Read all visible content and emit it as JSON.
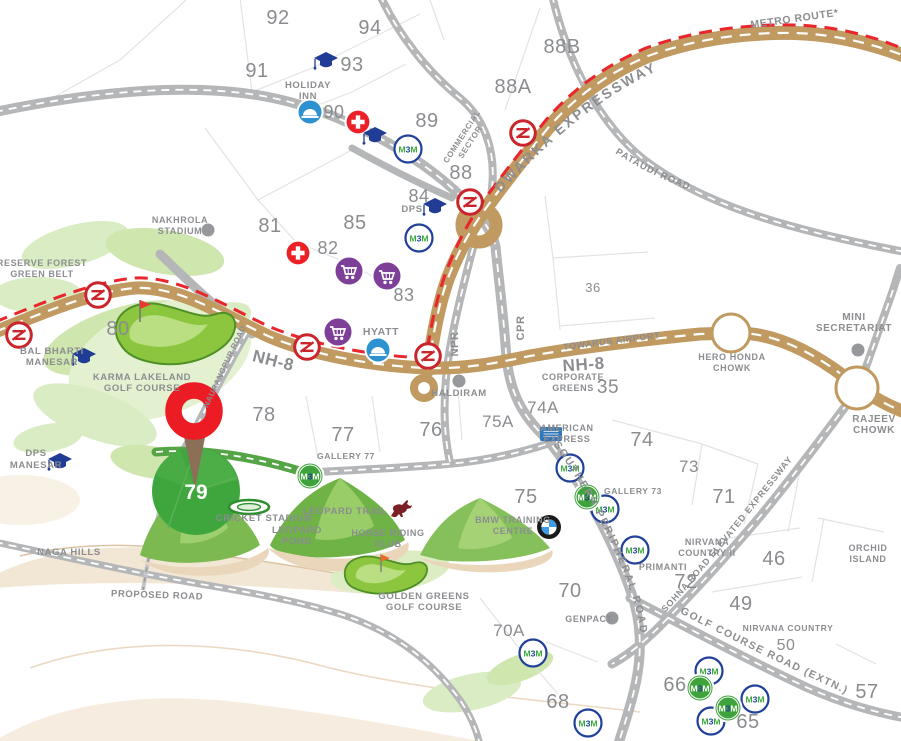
{
  "map": {
    "colors": {
      "highway_tan": "#c09a60",
      "road_gray": "#b5b6b8",
      "metro_red": "#e8262b",
      "label_gray": "#8b8d90",
      "project_green": "#3fa63e",
      "pin_red": "#ec1c24",
      "m3m_green": "#3aa63c",
      "m3m_blue": "#20409a",
      "cart_purple": "#7d3f98",
      "cap_blue": "#203c94",
      "hotel_blue": "#2d92cf",
      "hospital_red": "#ec2127",
      "horse_maroon": "#7b2125"
    },
    "logos": {
      "m3m_m1": "M",
      "m3m_3": "3",
      "m3m_m2": "M"
    },
    "project": {
      "number": "79"
    },
    "road_labels": {
      "dwarka": "DWARKA EXPRESSWAY",
      "pataudi": "PATAUDI ROAD",
      "naurangpur": "NAURANGPUR ROAD",
      "spr": "SOUTHERN PERIPHERAL ROAD",
      "sohna": "SOHNA ROAD ELEVATED EXPRESSWAY",
      "gcr": "GOLF COURSE ROAD (EXTN.)"
    },
    "sectors": [
      {
        "t": "92",
        "x": 278,
        "y": 24
      },
      {
        "t": "94",
        "x": 370,
        "y": 34
      },
      {
        "t": "93",
        "x": 352,
        "y": 71
      },
      {
        "t": "91",
        "x": 257,
        "y": 77
      },
      {
        "t": "90",
        "x": 334,
        "y": 118,
        "s": 18
      },
      {
        "t": "88B",
        "x": 562,
        "y": 53
      },
      {
        "t": "88A",
        "x": 513,
        "y": 93
      },
      {
        "t": "89",
        "x": 427,
        "y": 127
      },
      {
        "t": "88",
        "x": 461,
        "y": 179
      },
      {
        "t": "84",
        "x": 419,
        "y": 202,
        "s": 18
      },
      {
        "t": "85",
        "x": 355,
        "y": 229
      },
      {
        "t": "81",
        "x": 270,
        "y": 232
      },
      {
        "t": "82",
        "x": 328,
        "y": 254,
        "s": 18
      },
      {
        "t": "83",
        "x": 404,
        "y": 301,
        "s": 18
      },
      {
        "t": "80",
        "x": 118,
        "y": 335
      },
      {
        "t": "36",
        "x": 593,
        "y": 292,
        "s": 13
      },
      {
        "t": "35",
        "x": 608,
        "y": 393,
        "s": 19
      },
      {
        "t": "78",
        "x": 264,
        "y": 421
      },
      {
        "t": "77",
        "x": 343,
        "y": 441
      },
      {
        "t": "76",
        "x": 431,
        "y": 436
      },
      {
        "t": "75A",
        "x": 498,
        "y": 427,
        "s": 17
      },
      {
        "t": "74A",
        "x": 543,
        "y": 413,
        "s": 17
      },
      {
        "t": "74",
        "x": 642,
        "y": 446
      },
      {
        "t": "73",
        "x": 689,
        "y": 472,
        "s": 17
      },
      {
        "t": "71",
        "x": 724,
        "y": 503
      },
      {
        "t": "75",
        "x": 526,
        "y": 503
      },
      {
        "t": "70",
        "x": 570,
        "y": 597
      },
      {
        "t": "70A",
        "x": 509,
        "y": 636,
        "s": 17
      },
      {
        "t": "72",
        "x": 686,
        "y": 588
      },
      {
        "t": "46",
        "x": 774,
        "y": 565
      },
      {
        "t": "49",
        "x": 741,
        "y": 610
      },
      {
        "t": "50",
        "x": 786,
        "y": 650,
        "s": 16
      },
      {
        "t": "68",
        "x": 558,
        "y": 708
      },
      {
        "t": "66",
        "x": 675,
        "y": 691
      },
      {
        "t": "65",
        "x": 748,
        "y": 728
      },
      {
        "t": "57",
        "x": 867,
        "y": 698
      }
    ],
    "places": [
      {
        "id": "reserve-forest",
        "lines": [
          "RESERVE FOREST",
          "GREEN BELT"
        ],
        "x": 42,
        "y": 266,
        "s": 9
      },
      {
        "id": "bal-bharti-manesar",
        "lines": [
          "BAL BHARTI",
          "MANESAR"
        ],
        "x": 52,
        "y": 354,
        "s": 9.5
      },
      {
        "id": "karma-lakeland-golf-course",
        "lines": [
          "KARMA LAKELAND",
          "GOLF COURSE"
        ],
        "x": 142,
        "y": 380,
        "s": 9.5
      },
      {
        "id": "nakhrola-stadium",
        "lines": [
          "NAKHROLA",
          "STADIUM"
        ],
        "x": 180,
        "y": 223,
        "s": 9
      },
      {
        "id": "holiday-inn",
        "lines": [
          "HOLIDAY",
          "INN"
        ],
        "x": 308,
        "y": 88,
        "s": 9.5
      },
      {
        "id": "hyatt",
        "lines": [
          "HYATT"
        ],
        "x": 381,
        "y": 335,
        "s": 10.5
      },
      {
        "id": "dps",
        "lines": [
          "DPS"
        ],
        "x": 412,
        "y": 212,
        "s": 9.5
      },
      {
        "id": "dps-manesar",
        "lines": [
          "DPS",
          "MANESAR"
        ],
        "x": 36,
        "y": 456,
        "s": 9.5,
        "lh": 12
      },
      {
        "id": "mini-secretariat",
        "lines": [
          "MINI",
          "SECRETARIAT"
        ],
        "x": 854,
        "y": 320,
        "s": 10
      },
      {
        "id": "hero-honda-chowk",
        "lines": [
          "HERO HONDA",
          "CHOWK"
        ],
        "x": 732,
        "y": 360,
        "s": 9
      },
      {
        "id": "rajeev-chowk",
        "lines": [
          "RAJEEV",
          "CHOWK"
        ],
        "x": 874,
        "y": 422,
        "s": 10
      },
      {
        "id": "corporate-greens",
        "lines": [
          "CORPORATE",
          "GREENS"
        ],
        "x": 573,
        "y": 380,
        "s": 9
      },
      {
        "id": "american-express",
        "lines": [
          "AMERICAN",
          "EXPRESS"
        ],
        "x": 567,
        "y": 431,
        "s": 9,
        "a": "start"
      },
      {
        "id": "haldiram",
        "lines": [
          "HALDIRAM"
        ],
        "x": 459,
        "y": 396,
        "s": 9.5
      },
      {
        "id": "gallery-77",
        "lines": [
          "GALLERY 77"
        ],
        "x": 346,
        "y": 459,
        "s": 8.5
      },
      {
        "id": "gallery-73",
        "lines": [
          "GALLERY 73"
        ],
        "x": 633,
        "y": 494,
        "s": 8.5
      },
      {
        "id": "bmw-training-centre",
        "lines": [
          "BMW TRAINING",
          "CENTRE"
        ],
        "x": 513,
        "y": 523,
        "s": 9
      },
      {
        "id": "nirvana-country-ii",
        "lines": [
          "NIRVANA",
          "COUNTRY II"
        ],
        "x": 707,
        "y": 545,
        "s": 9
      },
      {
        "id": "primanti",
        "lines": [
          "PRIMANTI"
        ],
        "x": 663,
        "y": 570,
        "s": 9
      },
      {
        "id": "nirvana-country",
        "lines": [
          "NIRVANA COUNTRY"
        ],
        "x": 788,
        "y": 631,
        "s": 8.5
      },
      {
        "id": "orchid-island",
        "lines": [
          "ORCHID",
          "ISLAND"
        ],
        "x": 868,
        "y": 551,
        "s": 9
      },
      {
        "id": "genpact",
        "lines": [
          "GENPACT"
        ],
        "x": 589,
        "y": 622,
        "s": 9
      },
      {
        "id": "cricket-stadium",
        "lines": [
          "CRICKET STADIUM"
        ],
        "x": 264,
        "y": 521,
        "s": 9.5
      },
      {
        "id": "leopard-trail",
        "lines": [
          "LEOPARD TRAIL"
        ],
        "x": 345,
        "y": 514,
        "s": 9.5
      },
      {
        "id": "leopard-pond",
        "lines": [
          "LEOPARD",
          "POND"
        ],
        "x": 297,
        "y": 533,
        "s": 9.5
      },
      {
        "id": "horse-riding-club",
        "lines": [
          "HORSE RIDING",
          "CLUB"
        ],
        "x": 388,
        "y": 536,
        "s": 9,
        "a": "start"
      },
      {
        "id": "golden-greens-golf-course",
        "lines": [
          "GOLDEN GREENS",
          "GOLF COURSE"
        ],
        "x": 424,
        "y": 599,
        "s": 9.5
      },
      {
        "id": "naga-hills",
        "lines": [
          "NAGA HILLS"
        ],
        "x": 69,
        "y": 555,
        "s": 9.5
      },
      {
        "id": "proposed-road",
        "lines": [
          "PROPOSED ROAD"
        ],
        "x": 157,
        "y": 598,
        "s": 9.5,
        "rot": 2
      },
      {
        "id": "metro-route",
        "lines": [
          "METRO ROUTE*"
        ],
        "x": 795,
        "y": 22,
        "s": 10.5,
        "rot": -8
      },
      {
        "id": "towards-airport",
        "lines": [
          "TOWARDS AIRPORT"
        ],
        "x": 612,
        "y": 344,
        "s": 9,
        "rot": -7,
        "c": "#ffffff",
        "ls": 1.5
      },
      {
        "id": "nh8-west",
        "lines": [
          "NH-8"
        ],
        "x": 272,
        "y": 366,
        "s": 17,
        "rot": 14
      },
      {
        "id": "nh8-east",
        "lines": [
          "NH-8"
        ],
        "x": 584,
        "y": 370,
        "s": 17,
        "rot": -4
      },
      {
        "id": "cpr",
        "lines": [
          "CPR"
        ],
        "x": 524,
        "y": 328,
        "s": 11,
        "rot": -90
      },
      {
        "id": "npr",
        "lines": [
          "NPR"
        ],
        "x": 458,
        "y": 344,
        "s": 11,
        "rot": -90
      },
      {
        "id": "commercial-sector",
        "lines": [
          "COMMERCIAL",
          "SECTOR"
        ],
        "x": 464,
        "y": 138,
        "s": 8,
        "rot": -57,
        "lh": 10
      }
    ],
    "icons": [
      {
        "t": "metro",
        "x": 19,
        "y": 335,
        "click": true
      },
      {
        "t": "metro",
        "x": 98,
        "y": 295,
        "click": true
      },
      {
        "t": "metro",
        "x": 307,
        "y": 347,
        "click": true
      },
      {
        "t": "metro",
        "x": 428,
        "y": 356,
        "click": true
      },
      {
        "t": "metro",
        "x": 470,
        "y": 202,
        "click": true
      },
      {
        "t": "metro",
        "x": 523,
        "y": 133,
        "click": true
      },
      {
        "t": "m3m-blue",
        "x": 408,
        "y": 149,
        "click": true
      },
      {
        "t": "m3m-blue",
        "x": 419,
        "y": 238,
        "click": true
      },
      {
        "t": "m3m-blue",
        "x": 570,
        "y": 468,
        "click": true
      },
      {
        "t": "m3m-blue",
        "x": 605,
        "y": 509,
        "click": true
      },
      {
        "t": "m3m-blue",
        "x": 635,
        "y": 550,
        "click": true
      },
      {
        "t": "m3m-blue",
        "x": 533,
        "y": 653,
        "click": true
      },
      {
        "t": "m3m-blue",
        "x": 588,
        "y": 723,
        "click": true
      },
      {
        "t": "m3m-blue",
        "x": 709,
        "y": 671,
        "click": true
      },
      {
        "t": "m3m-blue",
        "x": 755,
        "y": 699,
        "click": true
      },
      {
        "t": "m3m-blue",
        "x": 711,
        "y": 721,
        "click": true
      },
      {
        "t": "m3m-green",
        "x": 310,
        "y": 476,
        "click": true
      },
      {
        "t": "m3m-green",
        "x": 587,
        "y": 497,
        "click": true
      },
      {
        "t": "m3m-green",
        "x": 700,
        "y": 688,
        "click": true
      },
      {
        "t": "m3m-green",
        "x": 728,
        "y": 708,
        "click": true
      },
      {
        "t": "cart",
        "x": 349,
        "y": 271,
        "click": true
      },
      {
        "t": "cart",
        "x": 387,
        "y": 276,
        "click": true
      },
      {
        "t": "cart",
        "x": 338,
        "y": 332,
        "click": true
      },
      {
        "t": "cross",
        "x": 358,
        "y": 122,
        "click": true
      },
      {
        "t": "cross",
        "x": 298,
        "y": 253,
        "click": true
      },
      {
        "t": "cap",
        "x": 326,
        "y": 61,
        "click": true
      },
      {
        "t": "cap",
        "x": 375,
        "y": 136,
        "click": true
      },
      {
        "t": "cap",
        "x": 435,
        "y": 207,
        "click": true
      },
      {
        "t": "cap",
        "x": 84,
        "y": 357,
        "click": true
      },
      {
        "t": "cap",
        "x": 60,
        "y": 462,
        "click": true
      },
      {
        "t": "hotel",
        "x": 310,
        "y": 112,
        "click": true
      },
      {
        "t": "hotel",
        "x": 378,
        "y": 350,
        "click": true
      },
      {
        "t": "dot",
        "x": 208,
        "y": 230,
        "click": false
      },
      {
        "t": "dot",
        "x": 459,
        "y": 381,
        "click": false
      },
      {
        "t": "dot",
        "x": 858,
        "y": 350,
        "click": false
      },
      {
        "t": "dot",
        "x": 612,
        "y": 618,
        "click": false
      },
      {
        "t": "bmw",
        "x": 549,
        "y": 527,
        "click": true
      },
      {
        "t": "amex",
        "x": 551,
        "y": 434,
        "click": true
      },
      {
        "t": "stadium",
        "x": 249,
        "y": 507,
        "click": false
      },
      {
        "t": "horse",
        "x": 402,
        "y": 509,
        "click": false
      },
      {
        "t": "flag-red",
        "x": 140,
        "y": 322,
        "click": false
      },
      {
        "t": "flag-orange",
        "x": 381,
        "y": 572,
        "sc": 0.8,
        "click": false
      }
    ]
  }
}
